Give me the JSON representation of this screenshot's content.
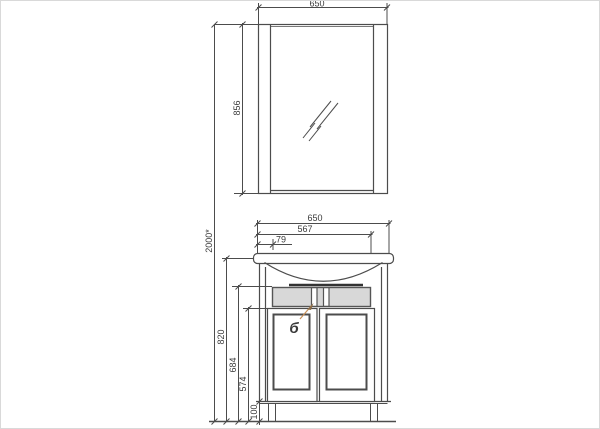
{
  "palette": {
    "line": "#4c4c4c",
    "thick_line": "#333333",
    "accent": "#e08a2e",
    "drawer_fill": "#d8d8d8",
    "background": "#ffffff"
  },
  "dimensions": {
    "mirror_width": "650",
    "mirror_height": "856",
    "overall_height": "2000*",
    "cabinet_width": "650",
    "basin_width": "567",
    "basin_offset": "79",
    "worktop_height": "820",
    "drawer_top_height": "684",
    "door_height": "574",
    "plinth_height": "100"
  },
  "callout": {
    "label": "б"
  }
}
